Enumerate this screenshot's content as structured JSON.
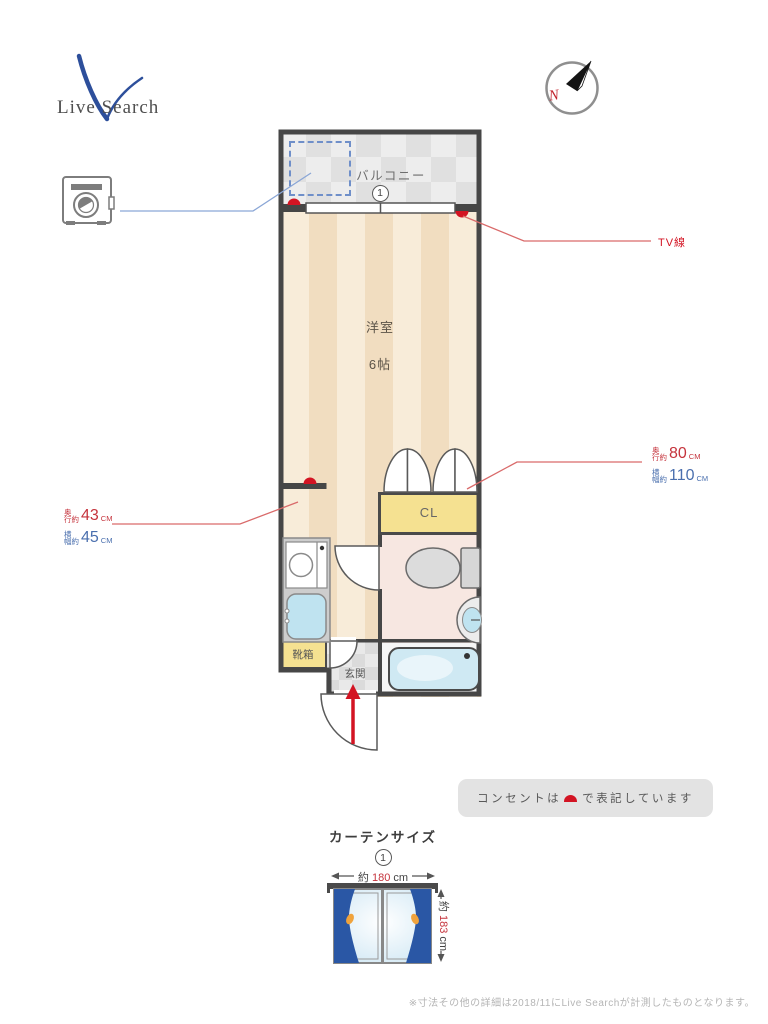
{
  "logo": {
    "text": "Live Search"
  },
  "compass": {
    "label": "N"
  },
  "plan": {
    "balcony_label": "バルコニー",
    "window_number": "1",
    "room_label": "洋室",
    "room_size": "6帖",
    "closet_label": "CL",
    "shoebox_label": "靴箱",
    "entrance_label": "玄関",
    "tv_label": "TV線"
  },
  "measurements": {
    "counter": {
      "depth_prefix_l1": "奥",
      "depth_prefix_l2": "行約",
      "depth_value": "43",
      "depth_unit": "CM",
      "width_prefix_l1": "横",
      "width_prefix_l2": "幅約",
      "width_value": "45",
      "width_unit": "CM"
    },
    "closet": {
      "depth_prefix_l1": "奥",
      "depth_prefix_l2": "行約",
      "depth_value": "80",
      "depth_unit": "CM",
      "width_prefix_l1": "横",
      "width_prefix_l2": "幅約",
      "width_value": "110",
      "width_unit": "CM"
    }
  },
  "outlet_note": {
    "prefix": "コンセントは",
    "suffix": "で表記しています"
  },
  "curtain": {
    "title": "カーテンサイズ",
    "number": "1",
    "width_prefix": "約",
    "width_value": "180",
    "width_unit": "cm",
    "height_prefix": "約",
    "height_value": "183",
    "height_unit": "cm"
  },
  "footer": {
    "note": "※寸法その他の詳細は2018/11にLive Searchが計測したものとなります。"
  },
  "colors": {
    "wall": "#4a4a4a",
    "accent_red": "#d31423",
    "measure_red": "#c5333c",
    "measure_blue": "#4a6fae",
    "leader_red": "#d96a6a",
    "leader_blue": "#8aa6d6",
    "floor_stripe_a": "#f8ecd9",
    "floor_stripe_b": "#f1ddc0",
    "balcony_tile_a": "#ededed",
    "balcony_tile_b": "#e0e0e0",
    "closet_yellow": "#f5e191",
    "bathroom_pink": "#f7e7e1",
    "tub_blue": "#cfe9f3",
    "curtain_blue": "#2a57a5",
    "tieback_orange": "#f0a33c",
    "logo_blue": "#2d4f9b",
    "notice_bg": "#e3e3e3"
  }
}
